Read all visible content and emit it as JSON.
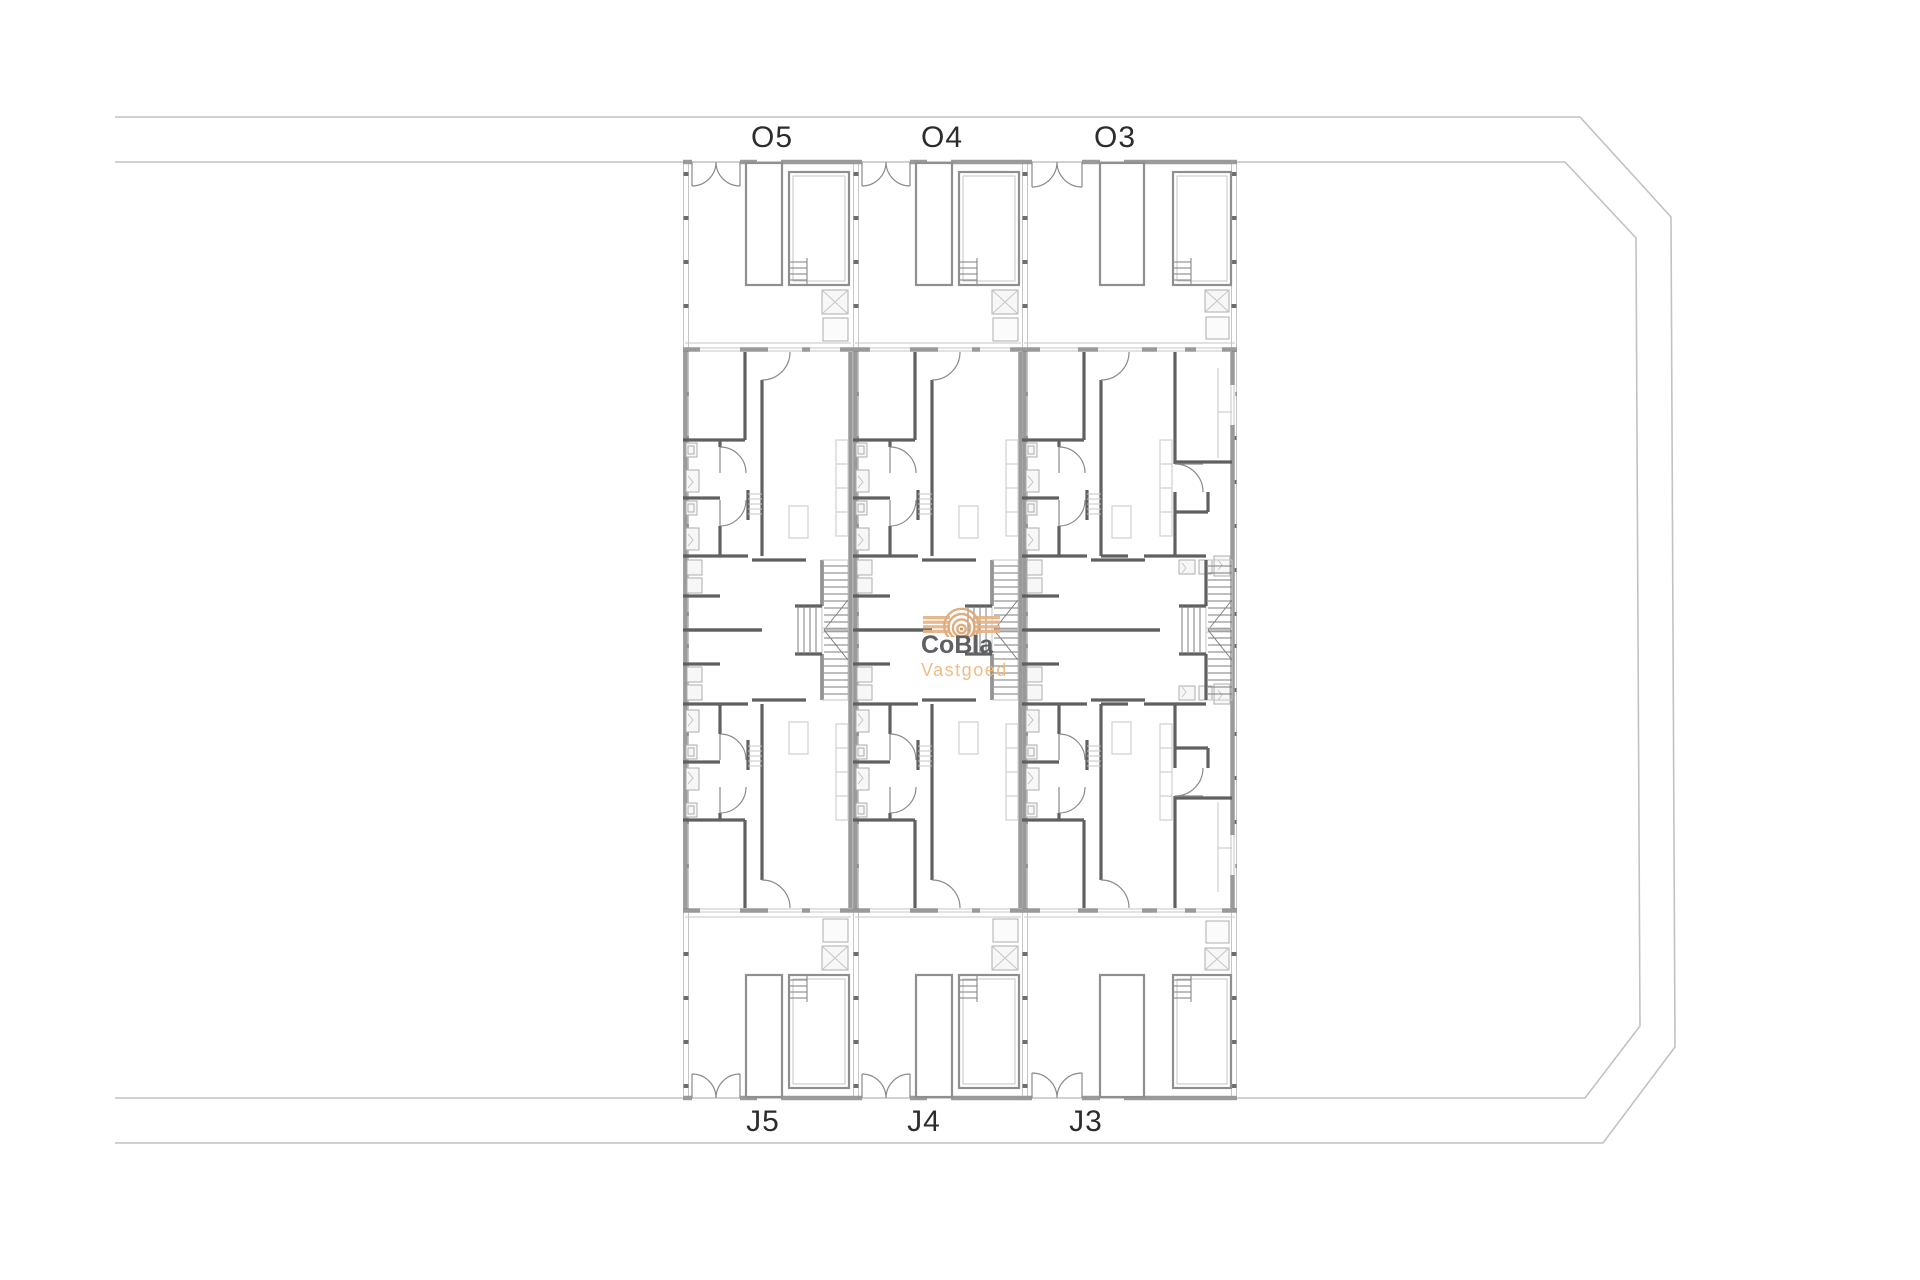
{
  "document": {
    "type": "architectural-site-floor-plan",
    "background": "#ffffff",
    "description": "Site plan with six townhouse units in three mirrored columns"
  },
  "labels": {
    "top": [
      "O5",
      "O4",
      "O3"
    ],
    "bottom": [
      "J5",
      "J4",
      "J3"
    ]
  },
  "watermark": {
    "brand": "CoBla",
    "subtitle": "Vastgoed",
    "brand_color": "#57585b",
    "subtitle_color": "#eeb97e",
    "logo_icon": "concentric-arcs-logo",
    "accent_color": "#e5b586"
  },
  "plan_colors": {
    "site_boundary": "#c2c2c2",
    "exterior_wall": "#9a9a9a",
    "interior_wall": "#606060",
    "detail_line": "#c6c6c6",
    "label_text": "#2c2c2c"
  }
}
